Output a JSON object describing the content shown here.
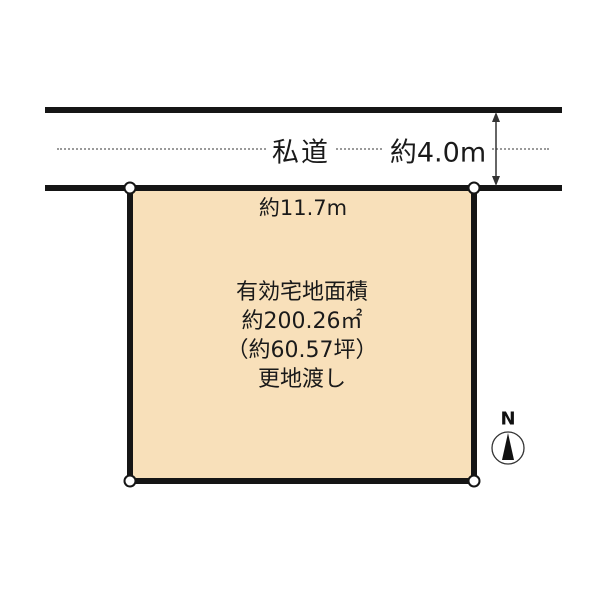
{
  "diagram": {
    "title": "land-plot-survey-diagram",
    "road": {
      "name_label": "私道",
      "width_label": "約4.0m"
    },
    "plot": {
      "frontage_label": "約11.7m",
      "text_line1": "有効宅地面積",
      "text_line2": "約200.26㎡",
      "text_line3": "（約60.57坪）",
      "text_line4": "更地渡し"
    },
    "compass": {
      "north_label": "N"
    },
    "colors": {
      "plot_fill": "#f8e0ba",
      "line": "#151515",
      "road_centerline": "#9a9a9a",
      "background": "#ffffff"
    }
  }
}
